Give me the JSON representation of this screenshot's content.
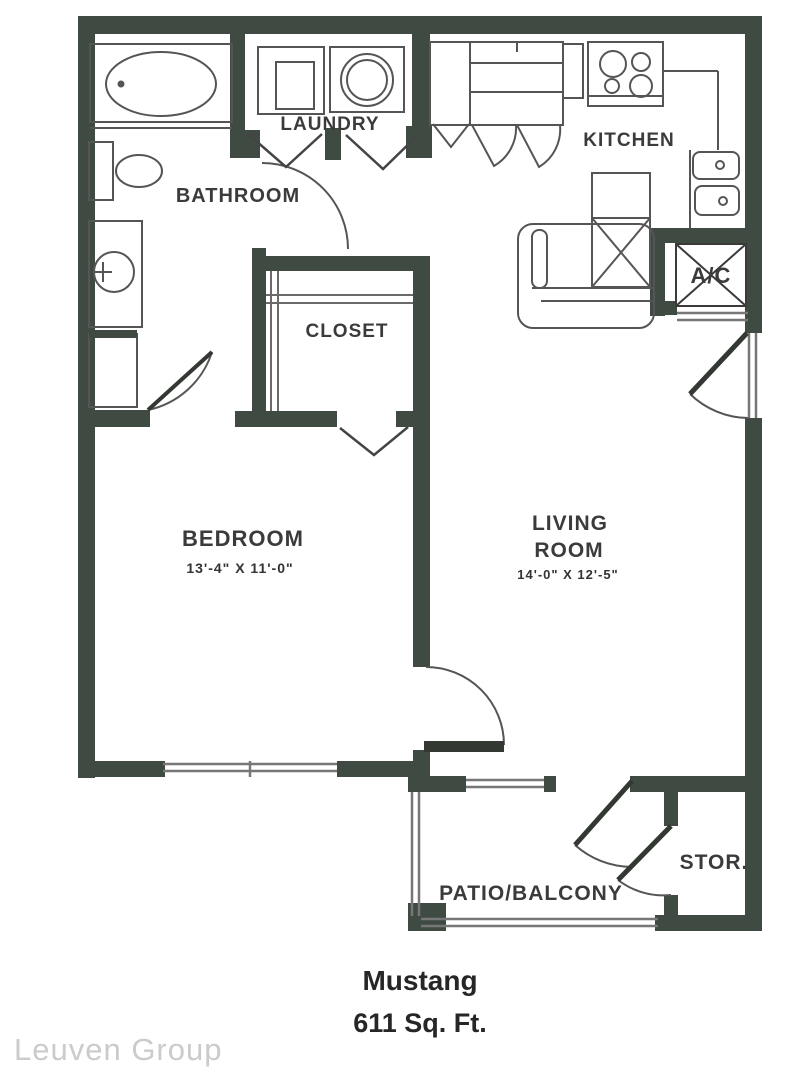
{
  "floorplan": {
    "rooms": {
      "laundry": "LAUNDRY",
      "bathroom": "BATHROOM",
      "kitchen": "KITCHEN",
      "closet": "CLOSET",
      "bedroom": "BEDROOM",
      "bedroom_dims": "13'-4\" X 11'-0\"",
      "living1": "LIVING",
      "living2": "ROOM",
      "living_dims": "14'-0\" X 12'-5\"",
      "ac": "A/C",
      "storage": "STOR.",
      "patio": "PATIO/BALCONY"
    },
    "title": {
      "name": "Mustang",
      "area": "611 Sq. Ft."
    },
    "watermark": "Leuven Group",
    "colors": {
      "wall": "#3e4a42",
      "door_leaf": "#333833",
      "fixture_line": "#555555",
      "window_line": "#777777",
      "label_text": "#3b3b3b",
      "title_text": "#262626",
      "watermark_text": "#cbcbcb"
    }
  }
}
